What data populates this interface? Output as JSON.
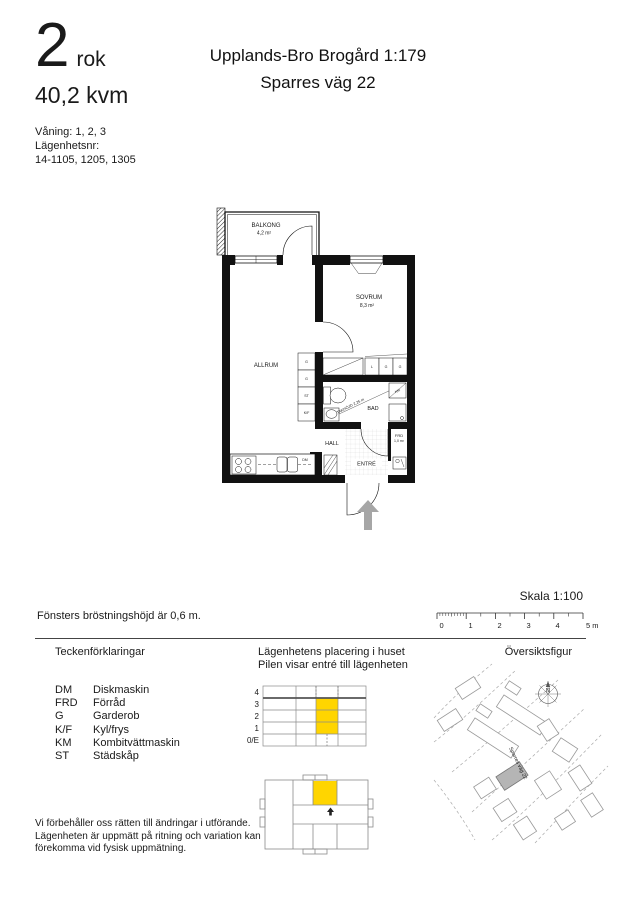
{
  "colors": {
    "highlight": "#ffd500",
    "arrow": "#a6a6a6",
    "building_fill": "#b5b5b5"
  },
  "header": {
    "rooms_number": "2",
    "rooms_unit": "rok",
    "area": "40,2 kvm",
    "floor_label": "Våning: 1, 2, 3",
    "apartment_no_label": "Lägenhetsnr:",
    "apartment_numbers": "14-1105, 1205, 1305",
    "title_line1": "Upplands-Bro Brogård 1:179",
    "title_line2": "Sparres väg 22"
  },
  "plan": {
    "balkong": "BALKONG",
    "balkong_area": "4,2 m²",
    "sovrum": "SOVRUM",
    "sovrum_area": "8,3 m²",
    "allrum": "ALLRUM",
    "bad": "BAD",
    "hall": "HALL",
    "entre": "ENTRÉ",
    "frd": "FRD",
    "frd_area": "1,0 m²",
    "ceiling_note": "TAKHÖJD 2,25 m",
    "km": "KM",
    "dm": "DM",
    "closets": [
      "G",
      "G",
      "ST",
      "K/F"
    ],
    "wardrobes": [
      "L",
      "G",
      "G"
    ]
  },
  "scalebar": {
    "label": "Skala 1:100",
    "ticks": [
      "0",
      "1",
      "2",
      "3",
      "4",
      "5 m"
    ]
  },
  "window_note": "Fönsters bröstningshöjd är 0,6 m.",
  "legend": {
    "title": "Teckenförklaringar",
    "items": [
      {
        "abbr": "DM",
        "label": "Diskmaskin"
      },
      {
        "abbr": "FRD",
        "label": "Förråd"
      },
      {
        "abbr": "G",
        "label": "Garderob"
      },
      {
        "abbr": "K/F",
        "label": "Kyl/frys"
      },
      {
        "abbr": "KM",
        "label": "Kombitvättmaskin"
      },
      {
        "abbr": "ST",
        "label": "Städskåp"
      }
    ]
  },
  "placement": {
    "title_line1": "Lägenhetens placering i huset",
    "title_line2": "Pilen visar entré till lägenheten",
    "floors": [
      "4",
      "3",
      "2",
      "1",
      "0/E"
    ]
  },
  "overview": {
    "title": "Översiktsfigur",
    "street": "Sparres väg 22",
    "north": "N"
  },
  "disclaimer": {
    "line1": "Vi förbehåller oss rätten till ändringar i utförande.",
    "line2": "Lägenheten är uppmätt på ritning och variation kan",
    "line3": "förekomma vid fysisk uppmätning."
  }
}
